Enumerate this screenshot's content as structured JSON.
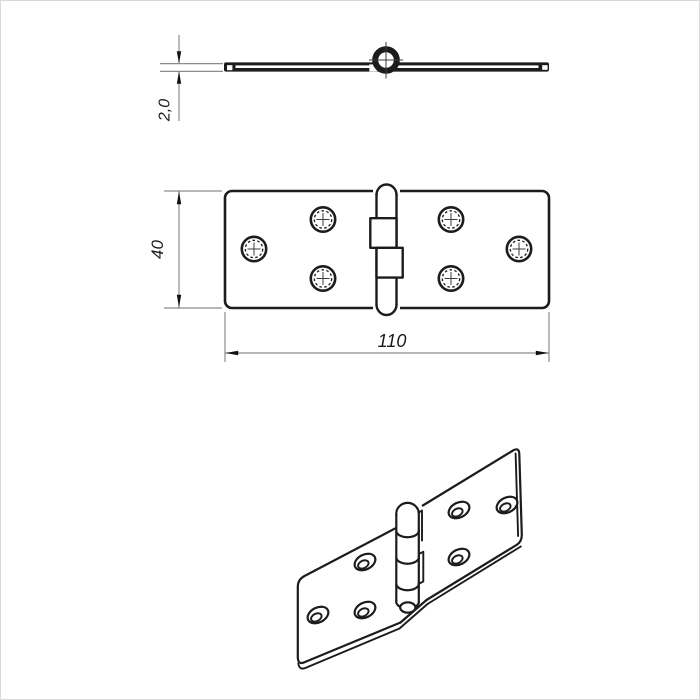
{
  "page": {
    "background": "#ffffff",
    "frame_color": "#d9d9d9"
  },
  "drawing": {
    "subject": "butt-hinge three-view technical drawing",
    "ink_color": "#1c1c1c",
    "dim_color": "#8c8c8c",
    "dimensions": {
      "thickness": "2,0",
      "height": "40",
      "width": "110"
    },
    "views": [
      {
        "id": "side-view",
        "holes_visible": 0
      },
      {
        "id": "plan-view",
        "holes_visible": 6
      },
      {
        "id": "isometric-view",
        "holes_visible": 6
      }
    ]
  }
}
